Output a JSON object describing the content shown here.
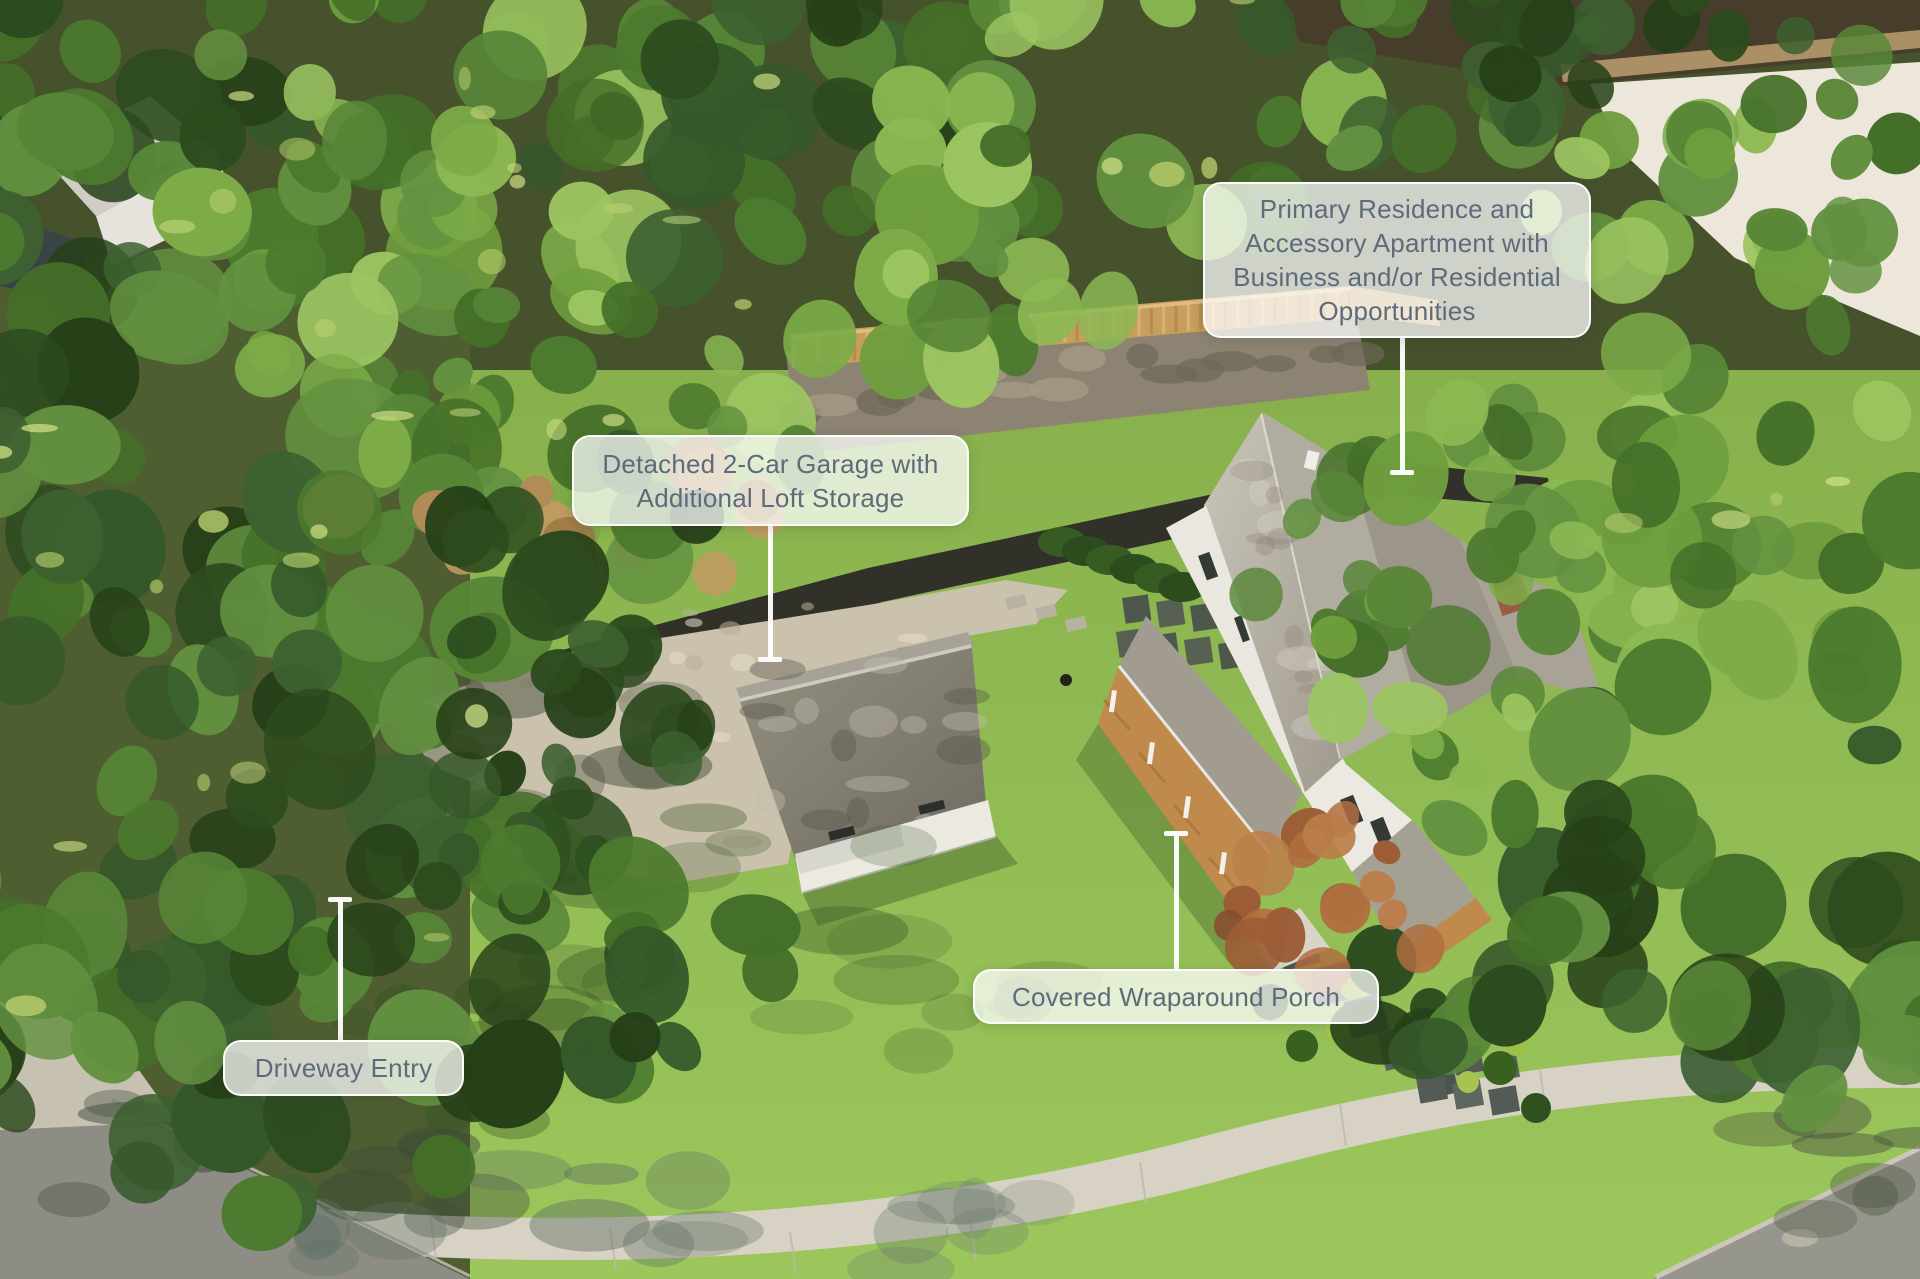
{
  "annotations": [
    {
      "id": "primary-residence",
      "label": "Primary Residence and Accessory Apartment with Business and/or Residential Opportunities"
    },
    {
      "id": "detached-garage",
      "label": "Detached 2-Car Garage with Additional Loft Storage"
    },
    {
      "id": "wraparound-porch",
      "label": "Covered Wraparound Porch"
    },
    {
      "id": "driveway-entry",
      "label": "Driveway Entry"
    }
  ],
  "colors": {
    "label_text": "#5d6b7a",
    "label_background": "rgba(255,255,255,0.74)",
    "leader_line": "#ffffff"
  }
}
